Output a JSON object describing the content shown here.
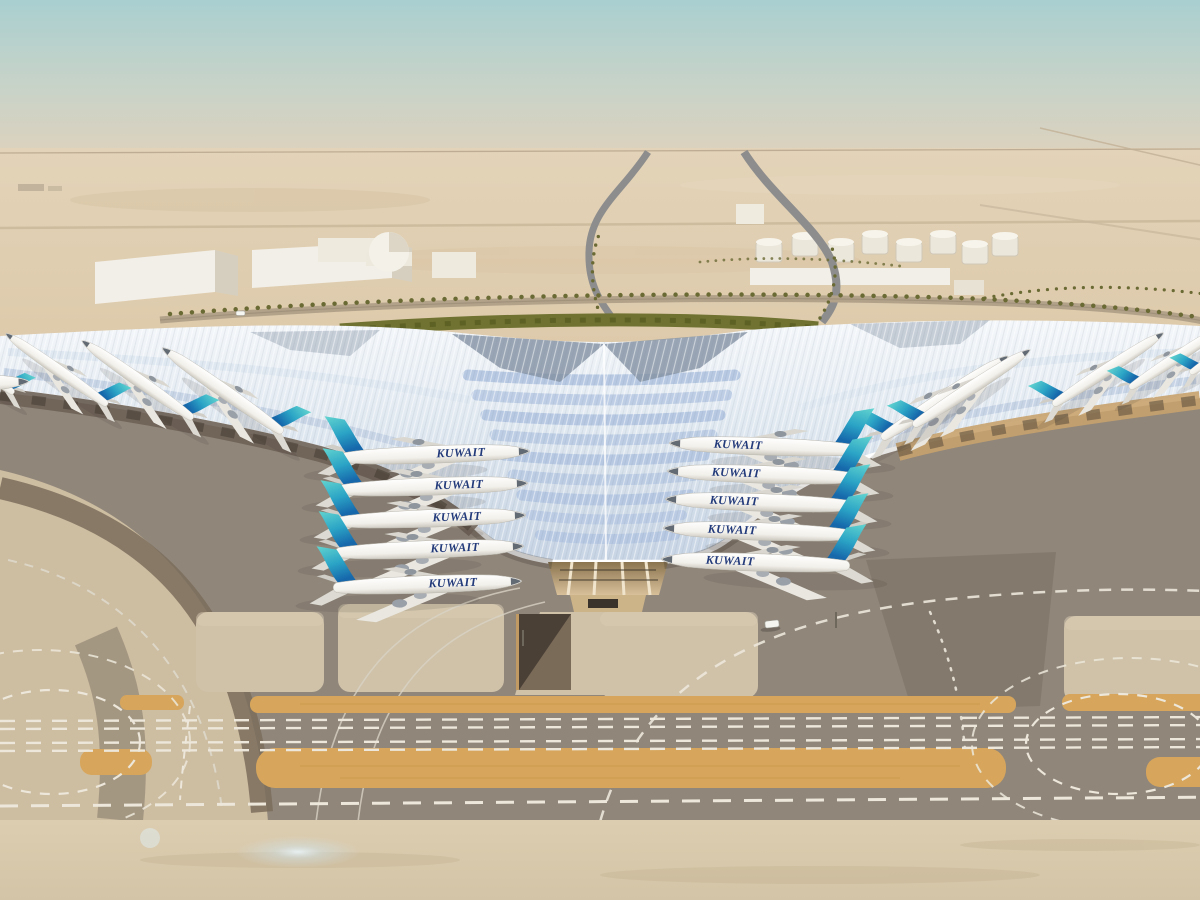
{
  "image": {
    "type": "aerial-architectural-rendering",
    "subject": "Desert airport terminal with white trefoil canopy roof, blue solar-panel bands and parked airliners",
    "setting": "desert under hazy pale sky",
    "time_of_day": "day"
  },
  "airline": {
    "title": "KUWAIT"
  },
  "aircraft": {
    "total_visible": 20,
    "left_concourse": 5,
    "right_concourse": 5,
    "left_pier": 4,
    "right_pier": 5,
    "partial_left_edge": 1,
    "livery": "white fuselage, teal-to-blue gradient tail fin, dark blue KUWAIT titles"
  },
  "terminal": {
    "roof": "white ribbed trefoil canopy with pale-blue chevron solar panels",
    "wings": 3,
    "entrance": "glazed tapering-column facade at apex",
    "landscape": "palm-lined loop road and green hedge behind roof"
  },
  "landside": {
    "warehouses": 4,
    "dome": 1,
    "fuel_tanks": 8,
    "access_ramps": 2,
    "palm_rows": true
  },
  "airside": {
    "shoulder_strips": 2,
    "guidelines": "white dashed taxi lines with loop junctions left and right",
    "stands": "light concrete stand patches with sunken service ramp",
    "vehicles": [
      "white car on apron",
      "white car on approach road"
    ]
  },
  "palette": {
    "sky-top": "#a9cfd0",
    "sky-mid": "#c8d3c8",
    "sky-haze": "#ded2bd",
    "desert-far": "#e3d3b8",
    "desert-mid": "#dcc8a8",
    "apron": "#90867a",
    "apron-dark": "#7c7264",
    "apron-band": "#7b6d5c",
    "stand-concrete": "#cfc2a9",
    "sand-corner": "#cdbda1",
    "sand-bottom": "#d4c4a7",
    "shoulder-tan": "#d7a65c",
    "marking": "#ece7da",
    "roof-light": "#eef2f7",
    "roof-blue": "#b6c8e2",
    "roof-slate": "#8391a3",
    "fascia": "#ffffff",
    "canopy-warm": "#c8a26d",
    "canopy-dark": "#6e6257",
    "fin-teal": "#62d4cf",
    "fin-mid": "#2ba4c6",
    "fin-blue": "#1668ab",
    "title-blue": "#223a7a",
    "palm": "#6a6a34",
    "hedge": "#6f7230",
    "building": "#f2efe8",
    "building-shade": "#d6cfbf",
    "tank": "#ece7db",
    "road": "#8d8d8d"
  }
}
